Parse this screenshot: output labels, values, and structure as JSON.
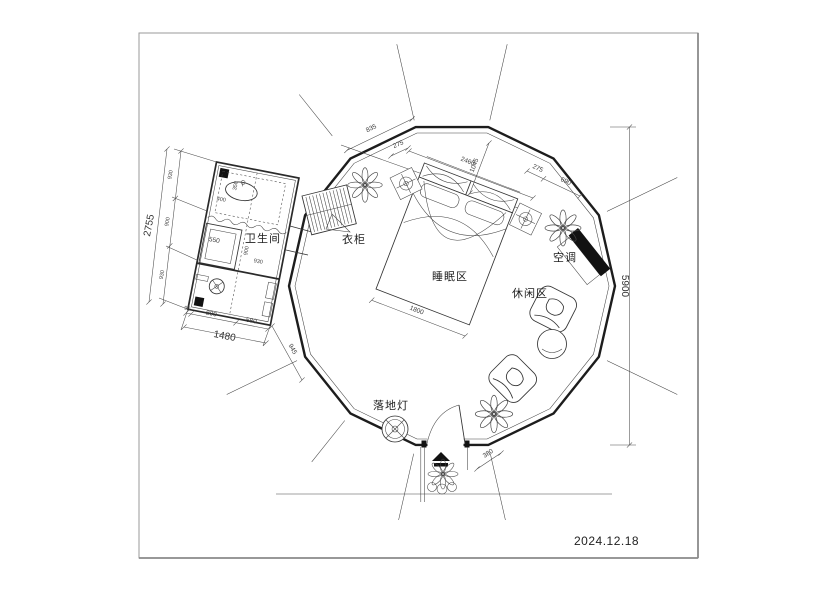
{
  "drawing": {
    "date": "2024.12.18",
    "room_labels": {
      "bathroom": "卫生间",
      "wardrobe": "衣柜",
      "sleeping_area": "睡眠区",
      "leisure_area": "休闲区",
      "air_conditioner": "空调",
      "floor_lamp": "落地灯"
    },
    "dimensions": {
      "left_overall": "2755",
      "left_seg_1": "930",
      "left_seg_2": "900",
      "left_seg_3": "930",
      "bottom_gap": "90",
      "bottom_seg_1": "800",
      "bottom_seg_2": "580",
      "bottom_overall": "1480",
      "bath_diag": "945",
      "shower_width": "550",
      "bath_inner_h": "900",
      "bath_inner_w": "930",
      "vanity_w": "400",
      "vanity_d": "350",
      "top_edge": "835",
      "top_offset": "275",
      "top_span": "2460",
      "top_diag": "1045",
      "tr_offset": "275",
      "tr_edge": "690",
      "height_overall": "5900",
      "bed_width": "1800",
      "door_offset": "380"
    },
    "colors": {
      "wall_line": "#1d1d1d",
      "dim_line": "#4a4a4a",
      "solid_fill": "#121212",
      "frame": "#9a9a9a",
      "background": "#ffffff"
    }
  }
}
